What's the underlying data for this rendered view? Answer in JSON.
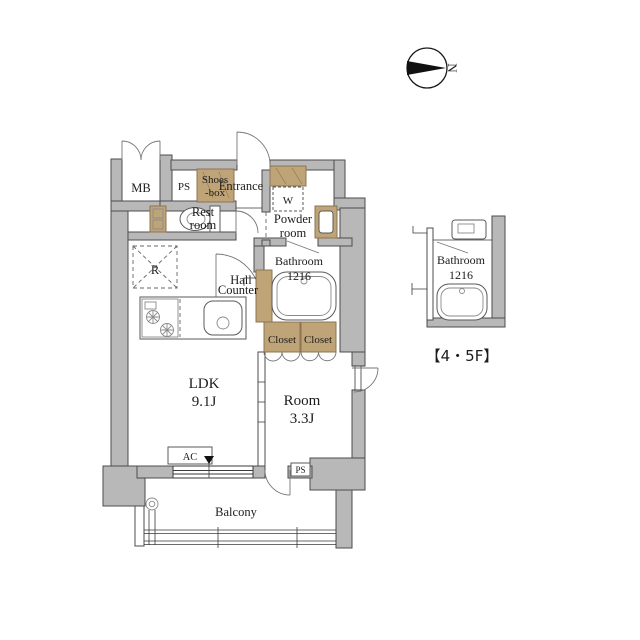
{
  "meta": {
    "type": "apartment-floor-plan"
  },
  "colors": {
    "background": "#ffffff",
    "wall_fill": "#b8b8b8",
    "wall_stroke": "#4c4c4c",
    "wood_fill": "#bfa478",
    "wood_stroke": "#8e7450",
    "line": "#3a3a3a",
    "text": "#1c1c1c"
  },
  "compass": {
    "north_label": "N"
  },
  "plan": {
    "mb": "MB",
    "ps_top": "PS",
    "shoes_box_line1": "Shoes",
    "shoes_box_line2": "-box",
    "entrance": "Entrance",
    "washer": "W",
    "rest_room_line1": "Rest",
    "rest_room_line2": "room",
    "powder_room_line1": "Powder",
    "powder_room_line2": "room",
    "hall": "Hall",
    "bathroom_line1": "Bathroom",
    "bathroom_line2": "1216",
    "counter": "Counter",
    "closet_left": "Closet",
    "closet_right": "Closet",
    "ldk_line1": "LDK",
    "ldk_line2": "9.1J",
    "room_line1": "Room",
    "room_line2": "3.3J",
    "ac": "AC",
    "refrigerator": "R",
    "ps_bottom": "PS",
    "balcony": "Balcony"
  },
  "inset": {
    "bathroom_line1": "Bathroom",
    "bathroom_line2": "1216",
    "floor_label": "【4・5F】"
  }
}
